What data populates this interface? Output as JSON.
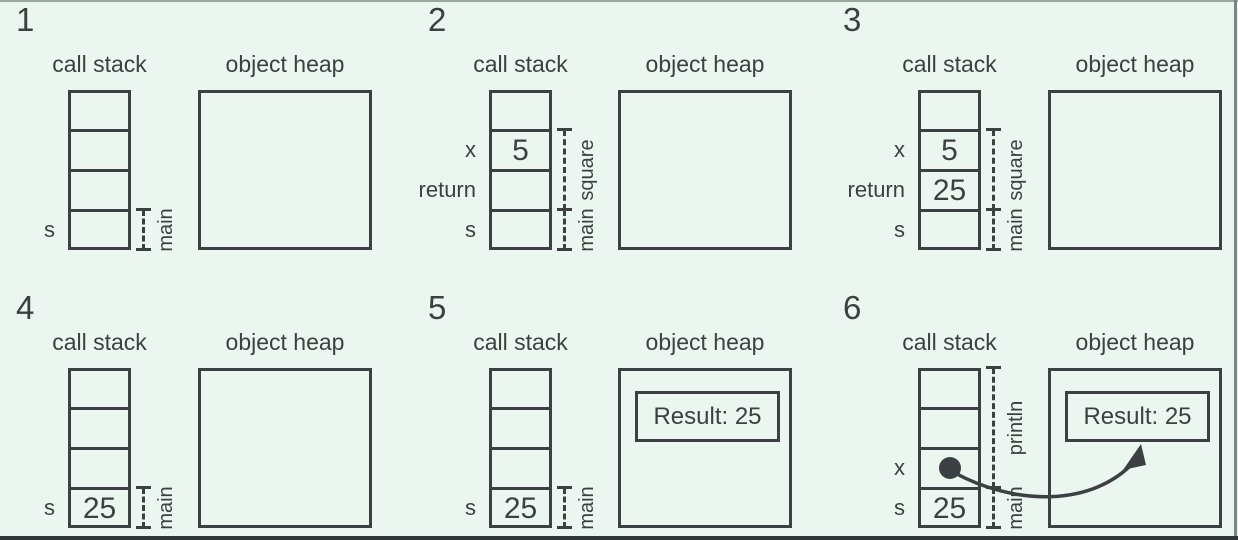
{
  "figure": {
    "background": "#ebf6f0",
    "stroke": "#3c4042",
    "panels": [
      {
        "number": "1",
        "stack_title": "call stack",
        "heap_title": "object heap",
        "cells": [
          {},
          {},
          {},
          {
            "label": "s"
          }
        ],
        "brackets": [
          {
            "label": "main",
            "from": 3,
            "to": 3
          }
        ],
        "heap": {}
      },
      {
        "number": "2",
        "stack_title": "call stack",
        "heap_title": "object heap",
        "cells": [
          {},
          {
            "label": "x",
            "value": "5"
          },
          {
            "label": "return"
          },
          {
            "label": "s"
          }
        ],
        "brackets": [
          {
            "label": "square",
            "from": 1,
            "to": 2
          },
          {
            "label": "main",
            "from": 3,
            "to": 3
          }
        ],
        "heap": {}
      },
      {
        "number": "3",
        "stack_title": "call stack",
        "heap_title": "object heap",
        "cells": [
          {},
          {
            "label": "x",
            "value": "5"
          },
          {
            "label": "return",
            "value": "25"
          },
          {
            "label": "s"
          }
        ],
        "brackets": [
          {
            "label": "square",
            "from": 1,
            "to": 2
          },
          {
            "label": "main",
            "from": 3,
            "to": 3
          }
        ],
        "heap": {}
      },
      {
        "number": "4",
        "stack_title": "call stack",
        "heap_title": "object heap",
        "cells": [
          {},
          {},
          {},
          {
            "label": "s",
            "value": "25"
          }
        ],
        "brackets": [
          {
            "label": "main",
            "from": 3,
            "to": 3
          }
        ],
        "heap": {}
      },
      {
        "number": "5",
        "stack_title": "call stack",
        "heap_title": "object heap",
        "cells": [
          {},
          {},
          {},
          {
            "label": "s",
            "value": "25"
          }
        ],
        "brackets": [
          {
            "label": "main",
            "from": 3,
            "to": 3
          }
        ],
        "heap": {
          "box": "Result: 25"
        }
      },
      {
        "number": "6",
        "stack_title": "call stack",
        "heap_title": "object heap",
        "cells": [
          {},
          {},
          {
            "label": "x",
            "dot": true
          },
          {
            "label": "s",
            "value": "25"
          }
        ],
        "brackets": [
          {
            "label": "println",
            "from": 0,
            "to": 2
          },
          {
            "label": "main",
            "from": 3,
            "to": 3
          }
        ],
        "heap": {
          "box": "Result: 25"
        },
        "arrow_to_heap": true
      }
    ]
  }
}
